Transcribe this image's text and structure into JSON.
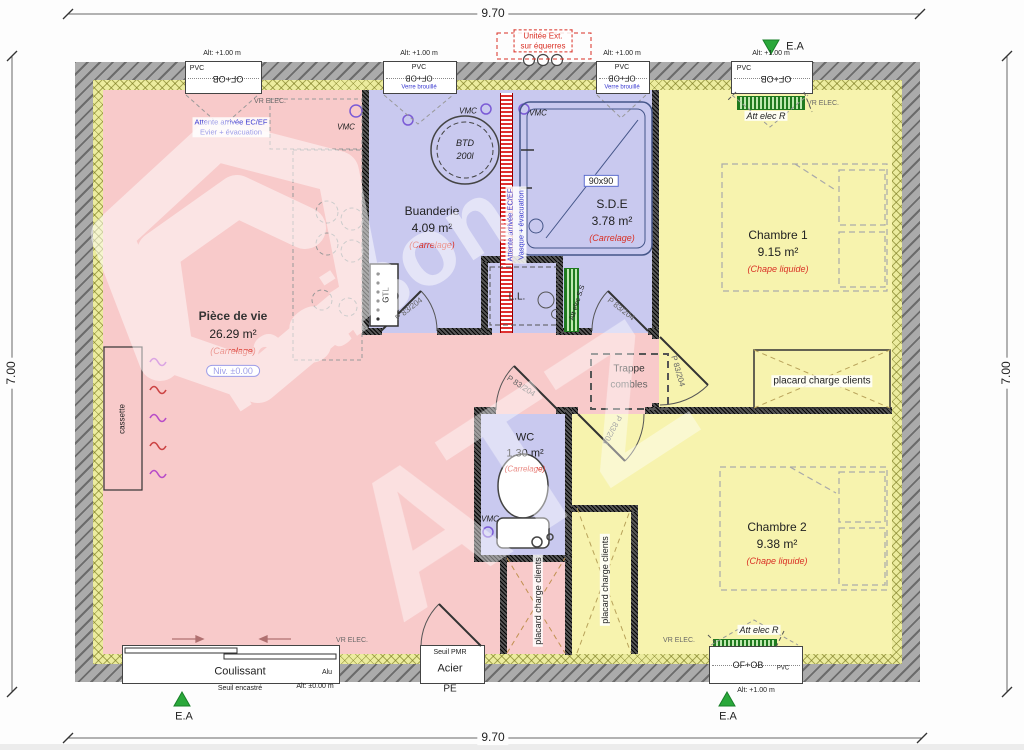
{
  "palette": {
    "room_pink": "#f8caca",
    "room_blue": "#c9c9ef",
    "room_yellow": "#f7f3ae",
    "wall_gray": "#ababab",
    "insulation_yellow": "#ecec9e",
    "accent_red": "#d93025",
    "accent_blue": "#3b3bd1",
    "accent_green": "#2aa83a"
  },
  "dimensions": {
    "width": "9.70",
    "height": "7.00"
  },
  "rooms": [
    {
      "name": "Pièce de vie",
      "area": "26.29 m²",
      "finish": "(Carrelage)",
      "level": "Niv. ±0.00"
    },
    {
      "name": "Buanderie",
      "area": "4.09 m²",
      "finish": "(Carrelage)"
    },
    {
      "name": "S.D.E",
      "area": "3.78 m²",
      "finish": "(Carrelage)"
    },
    {
      "name": "Chambre 1",
      "area": "9.15 m²",
      "finish": "(Chape liquide)"
    },
    {
      "name": "WC",
      "area": "1.30 m²",
      "finish": "(Carrelage)"
    },
    {
      "name": "Chambre 2",
      "area": "9.38 m²",
      "finish": "(Chape liquide)"
    }
  ],
  "windows": [
    {
      "alt": "Alt: +1.00 m",
      "material": "PVC",
      "type": "OF+OB"
    },
    {
      "alt": "Alt: +1.00 m",
      "material": "PVC",
      "type": "OF+OB",
      "glass": "Verre brouillé"
    },
    {
      "alt": "Alt: +1.00 m",
      "material": "PVC",
      "type": "OF+OB",
      "glass": "Verre brouillé"
    },
    {
      "alt": "Alt: +1.00 m",
      "material": "PVC",
      "type": "OF+OB"
    },
    {
      "alt": "Alt: +1.00 m",
      "material": "PVC",
      "type": "OF+OB"
    }
  ],
  "doors": {
    "interior_label": "P 83/204",
    "sliding": {
      "label": "Coulissant",
      "threshold": "Seuil encastré",
      "material": "Alu",
      "alt": "Alt: ±0.00 m"
    },
    "entry": {
      "threshold": "Seuil PMR",
      "material": "Acier",
      "type": "PE"
    }
  },
  "annotations": {
    "unit_ext_line1": "Unitée Ext.",
    "unit_ext_line2": "sur équerres",
    "ea": "E.A",
    "vr_elec": "VR ELEC.",
    "vmc": "VMC",
    "att_elec_r": "Att elec R",
    "att_elec_ss": "Att elec S.S",
    "attente_ecef": "Attente arrivée EC/EF",
    "attente_evier": "Evier + évacuation",
    "attente_vasque": "Vasque + évacuation",
    "btd_line1": "BTD",
    "btd_line2": "200l",
    "shower_size": "90x90",
    "washer": "L.L.",
    "gtl": "GTL",
    "cassette": "cassette",
    "trappe_line1": "Trappe",
    "trappe_line2": "combles",
    "placard": "placard charge clients"
  },
  "watermark": {
    "line1": "maison",
    "line2": "ATZ"
  }
}
